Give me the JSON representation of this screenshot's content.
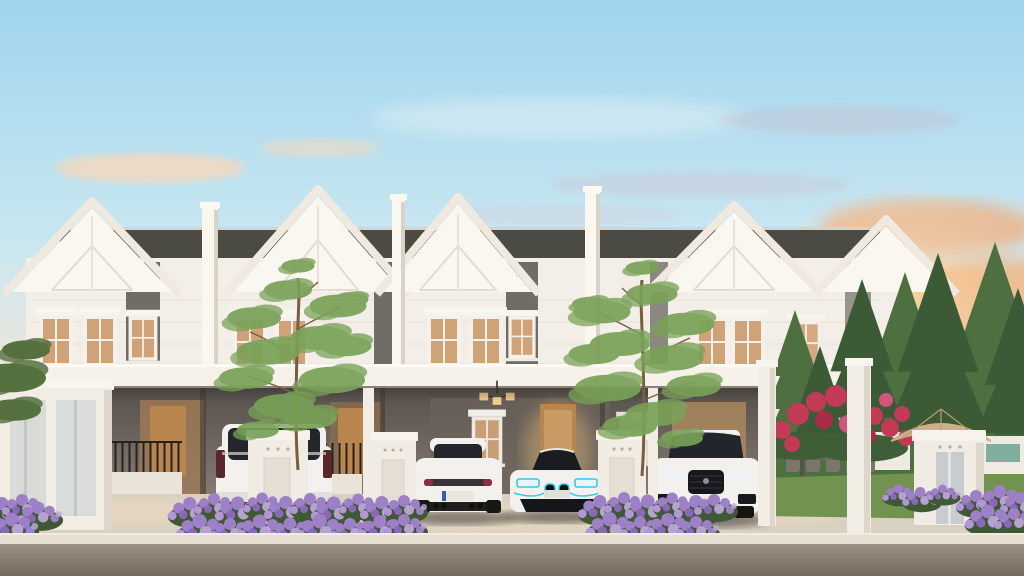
{
  "meta": {
    "kind": "architectural-render",
    "description": "Sunset 3D rendering of a row of white two-storey terraced houses with carports, four white luxury cars parked in front, purple flower beds, ornamental trees, a side garden with outdoor dining set, patio umbrella, red bougainvillea, tall pines and distant hills beyond an asphalt street."
  },
  "scene": {
    "sky": {
      "top": "#9fd4ee",
      "mid": "#c9e7f1",
      "warm": "#f3e6d6",
      "horizon": "#f9ddbd",
      "cloud_grey": "#c0b9cb",
      "cloud_orange": "#f2ae7e",
      "cloud_soft": "#f4d9bf",
      "glow": "#ffdcae"
    },
    "landscape": {
      "mountain": "#8a9aa0",
      "pine_dark": "#3c5a36",
      "pine_mid": "#4e7040",
      "lawn": "#72924f",
      "hedge": "#4e6f3f",
      "tree_foliage": "#79a158",
      "tree_trunk": "#7a5c3e",
      "flower_purple": "#9d80c5",
      "flower_purple_light": "#c2aade",
      "flower_green": "#3e5934",
      "flower_red": "#c23a56",
      "umbrella": "#cbb189"
    },
    "building": {
      "roof": "#4b4a43",
      "ridge": "#d8d3c8",
      "wall": "#f3eee7",
      "wall_bright": "#faf6f0",
      "wall_shade": "#e7e0d6",
      "dark_panel": "#6f6e66",
      "fascia": "#f6f1e9",
      "interior_dark": "#55504b",
      "interior_warm": "#8d8178",
      "door": "#b9854f",
      "glow": "#e9bc7d",
      "railing": "#26231f",
      "pillar": "#f1ece4",
      "frosted_glass": "#d8dbd7",
      "metal_door": "#c9ccce"
    },
    "vehicles": {
      "body_white": "#f3f1ed",
      "window": "#24262b",
      "i8_accent": "#38c9e8",
      "tail_dark": "#3a3236",
      "plate": "#e8e6df"
    },
    "ground": {
      "pavement": "#d9d0c2",
      "pavement_warm": "#eedcbd",
      "curb": "#e6dfd2",
      "road_top": "#9c9183",
      "road_bottom": "#746b60"
    },
    "objects": [
      "terraced-house-row",
      "gabled-roofs",
      "carport-canopy",
      "upper-floor-windows",
      "white-mpv-rear",
      "white-suv-rear",
      "white-sports-car-front",
      "white-suv-front",
      "gate-pillars",
      "porch-railings",
      "chandeliers",
      "purple-flower-beds",
      "ornamental-trees",
      "side-garden-lawn",
      "outdoor-dining-set",
      "patio-umbrella",
      "red-bougainvillea",
      "pine-trees",
      "distant-hills",
      "asphalt-street"
    ]
  }
}
